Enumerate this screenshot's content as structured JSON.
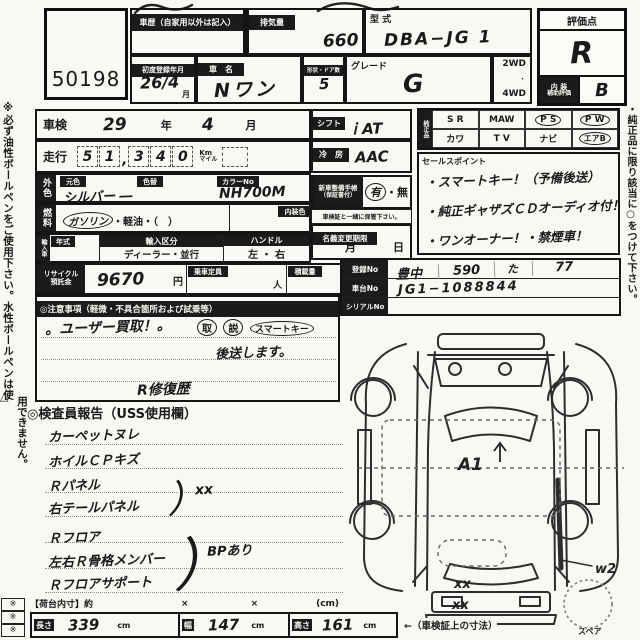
{
  "lot": {
    "number": "50198"
  },
  "top": {
    "history_label": "車歴（自家用以外は記入）",
    "displacement_label": "排気量",
    "displacement_value": "660",
    "model_code_label": "型 式",
    "model_code_value": "DBA−JG 1",
    "first_reg_label": "初度登録年月",
    "first_reg_value": "26/4",
    "first_reg_unit": "月",
    "car_name_label": "車　名",
    "car_name_value": "Nワン",
    "doors_label": "形状・ドア数",
    "doors_value": "5",
    "grade_label": "グレード",
    "grade_value": "G",
    "wd2": "2WD",
    "wd_dot": "・",
    "wd4": "4WD",
    "rating_label": "評価点",
    "rating_value": "R",
    "interior_label1": "内 装",
    "interior_label2": "補助評価",
    "interior_value": "B"
  },
  "left_note": {
    "line1": "※必ず油性ボールペンをご使用下さい。水性ボールペンは使",
    "line2": "用できません。",
    "triangle": "△"
  },
  "right_note": "・純正品に限り該当に○をつけて下さい。",
  "corner_marks": [
    "※",
    "※",
    "※"
  ],
  "main": {
    "shaken_label": "車検",
    "shaken_year": "29",
    "year_unit": "年",
    "shaken_month": "4",
    "month_unit": "月",
    "mileage_label": "走行",
    "mileage_digits": [
      "5",
      "1",
      "3",
      "4",
      "0"
    ],
    "mileage_comma": ",",
    "mileage_unit_km": "Km",
    "mileage_unit_mile": "マイル",
    "color_header": "外色",
    "base_color_label": "元色",
    "color_change_label": "色替",
    "base_color_value": "シルバー ―",
    "color_no_label": "カラーNo",
    "color_no_value": "NH700M",
    "fuel_header": "燃料",
    "fuel_gasoline": "ガソリン",
    "fuel_rest": "・軽油・（　）",
    "interior_color_label": "内装色",
    "import_header": "輸入車",
    "year_label": "年式",
    "import_label": "輸入区分",
    "import_value": "ディーラー・並行",
    "handle_label": "ハンドル",
    "handle_value": "左 ・ 右",
    "recycle_label1": "リサイクル",
    "recycle_label2": "預託金",
    "recycle_value": "9670",
    "recycle_unit": "円",
    "capacity_label": "乗車定員",
    "capacity_unit": "人",
    "load_label": "積載量"
  },
  "right_col": {
    "shift_label": "シフト",
    "shift_value": "ｉAT",
    "cooling_label": "冷　房",
    "cooling_value": "AAC",
    "service_label1": "新車整備手帳",
    "service_label2": "（保証書付）",
    "service_yes": "有",
    "service_sep": "・",
    "service_no": "無",
    "service_note": "車検証と一緒に保管下さい。",
    "name_change_label": "名義変更期限",
    "name_change_month": "月",
    "name_change_day": "日"
  },
  "equipment": {
    "header": "純正品",
    "row1": [
      "S R",
      "MAW",
      "P S",
      "P W"
    ],
    "row2": [
      "カワ",
      "T V",
      "ナビ",
      "エアB"
    ]
  },
  "sales": {
    "label": "セールスポイント",
    "item1": "・スマートキー！（予備後送）",
    "item2": "・純正ギャザズＣＤオーディオ付！",
    "item3": "・ワンオーナー！・禁煙車！"
  },
  "registration": {
    "reg_label": "登録No",
    "reg_area": "豊中",
    "reg_class": "590",
    "reg_kana": "た",
    "reg_num": "77",
    "chassis_label": "車台No",
    "chassis_value": "JG1−1088844",
    "serial_label": "シリアルNo",
    "serial_value": ""
  },
  "cautions": {
    "label": "◎注意事項（軽微・不具合箇所および試乗等）",
    "line1": "。ユーザー買取！。",
    "circle1": "取",
    "circle2": "説",
    "circle3": "スマートキー",
    "line2": "後送します。",
    "note": "R修復歴"
  },
  "report": {
    "label": "◎検査員報告（USS使用欄）",
    "item1": "カーペットヌレ",
    "item2": "ホイルＣＰキズ",
    "item3": "Ｒパネル",
    "item4": "右テールパネル",
    "bracket1_mark": "）",
    "bracket1_note": "xx",
    "item5": "Ｒフロア",
    "item6": "左右Ｒ骨格メンバー",
    "bracket2_mark": "）",
    "bracket2_note": "BPあり",
    "item7": "Ｒフロアサポート"
  },
  "diagram": {
    "mark_roof": "A1",
    "mark_rear1": "xx",
    "mark_rear2": "xx",
    "mark_side": "w2",
    "spare_label": "スペア"
  },
  "dims": {
    "inner_label": "【荷台内寸】約",
    "times1": "×",
    "times2": "×",
    "unit_note": "(cm)",
    "len_label": "長さ",
    "len_value": "339",
    "len_unit": "cm",
    "wid_label": "幅",
    "wid_value": "147",
    "wid_unit": "cm",
    "hei_label": "高さ",
    "hei_value": "161",
    "hei_unit": "cm",
    "cert_note": "←（車検証上の寸法）"
  }
}
